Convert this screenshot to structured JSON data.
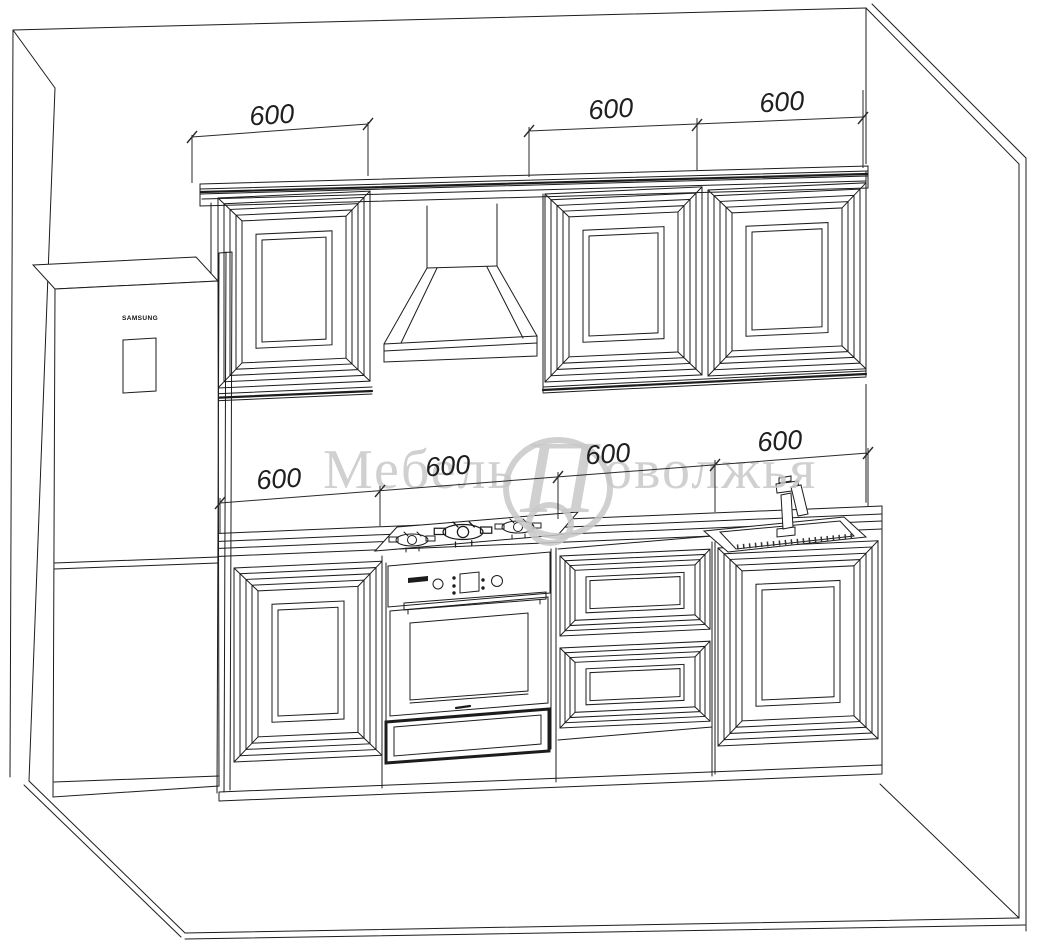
{
  "watermark": {
    "left": "Мебель",
    "monogram": "П",
    "right": "оволжья"
  },
  "fridge": {
    "brand": "SAMSUNG"
  },
  "dimensions": {
    "top": [
      "600",
      "600",
      "600"
    ],
    "middle": [
      "600",
      "600",
      "600",
      "600"
    ]
  },
  "colors": {
    "line": "#1c1c1c",
    "watermark": "#c8c8c8",
    "background": "#ffffff"
  }
}
